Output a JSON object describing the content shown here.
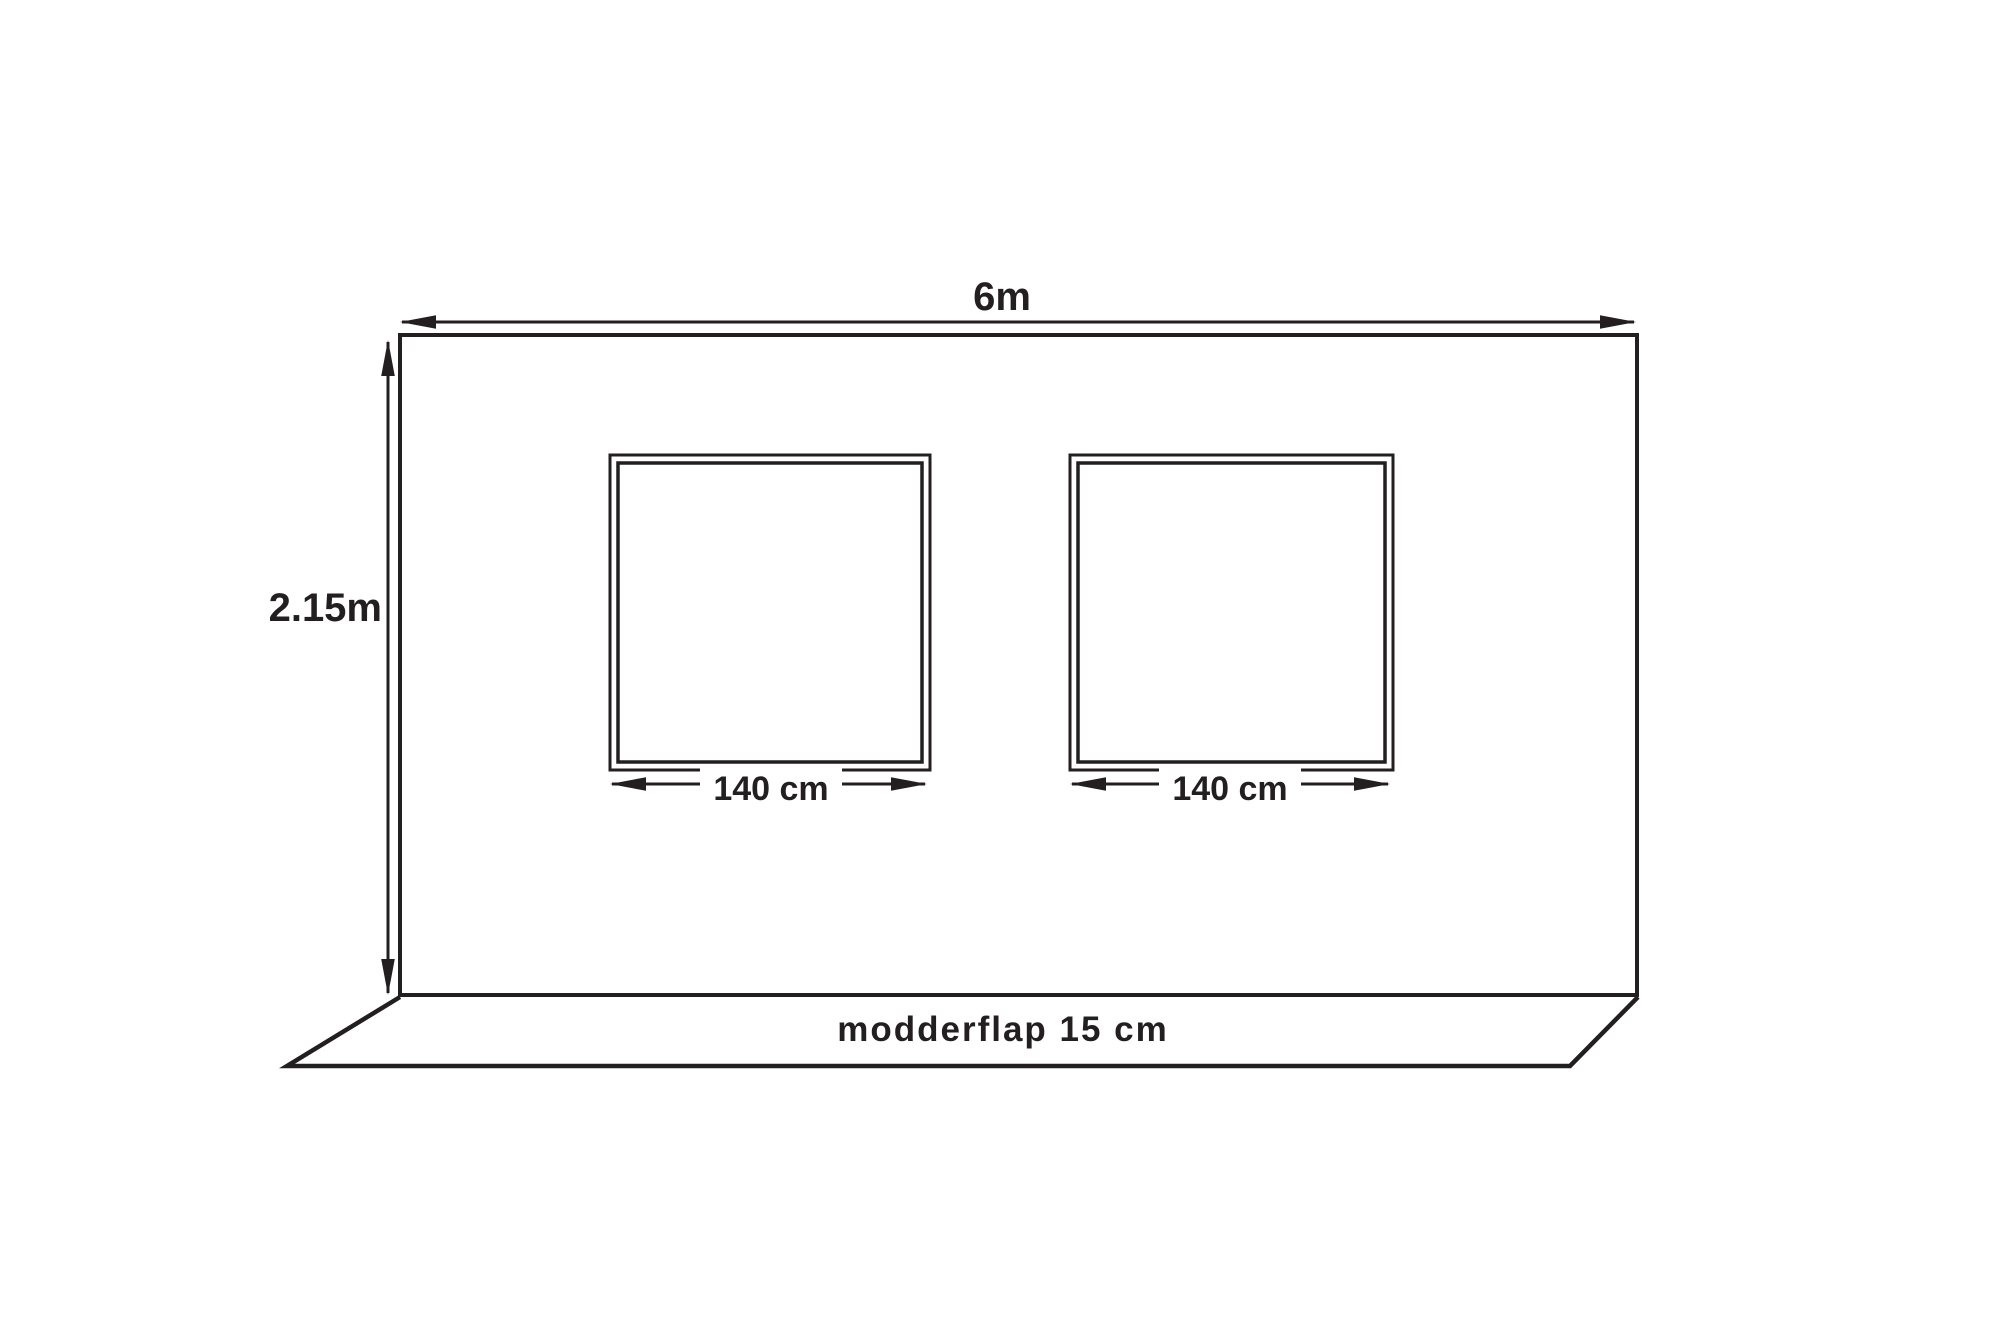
{
  "diagram": {
    "type": "dimensioned-technical-drawing",
    "background_color": "#ffffff",
    "line_color": "#231f20",
    "wall": {
      "width_label": "6m",
      "height_label": "2.15m"
    },
    "windows": [
      {
        "width_label": "140 cm"
      },
      {
        "width_label": "140 cm"
      }
    ],
    "flap": {
      "label": "modderflap 15 cm"
    }
  }
}
